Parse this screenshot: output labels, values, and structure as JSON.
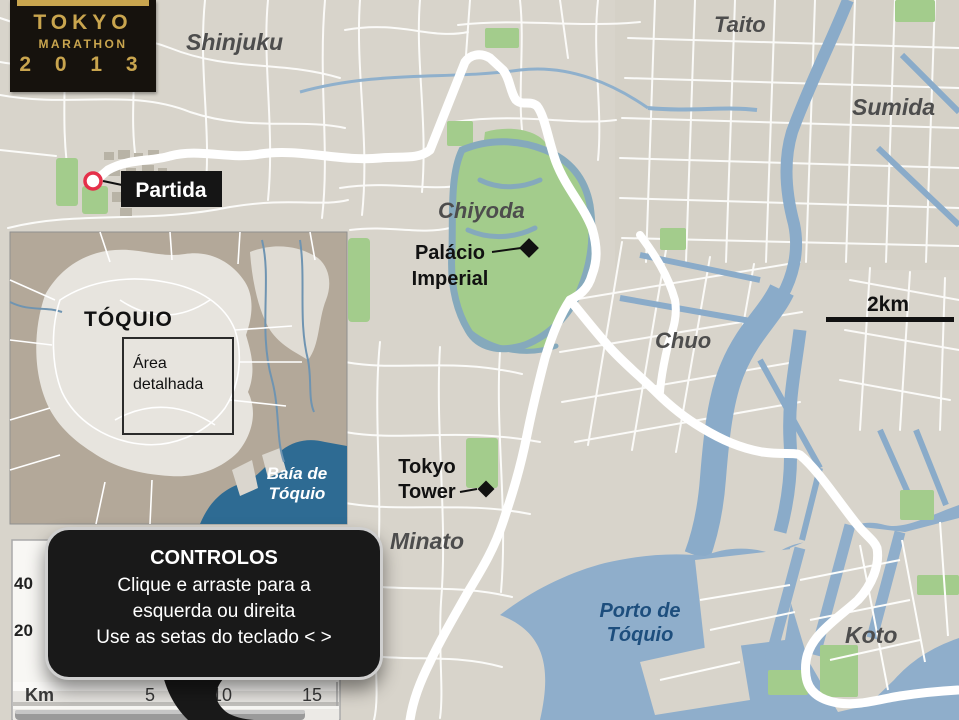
{
  "logo": {
    "title": "TOKYO",
    "subtitle": "MARATHON",
    "year": "2 0 1 3"
  },
  "map": {
    "districts": [
      {
        "label": "Shinjuku"
      },
      {
        "label": "Taito"
      },
      {
        "label": "Sumida"
      },
      {
        "label": "Chiyoda"
      },
      {
        "label": "Chuo"
      },
      {
        "label": "Minato"
      },
      {
        "label": "Koto"
      }
    ],
    "markers": {
      "start": {
        "label": "Partida"
      },
      "imperial_palace": {
        "line1": "Palácio",
        "line2": "Imperial"
      },
      "tokyo_tower": {
        "line1": "Tokyo",
        "line2": "Tower"
      }
    },
    "water_labels": {
      "port_line1": "Porto de",
      "port_line2": "Tóquio"
    },
    "scale_label": "2km"
  },
  "inset": {
    "title": "TÓQUIO",
    "area_line1": "Área",
    "area_line2": "detalhada",
    "bay_line1": "Baía de",
    "bay_line2": "Tóquio"
  },
  "elevation": {
    "y_ticks": [
      "40",
      "20"
    ],
    "x_unit": "Km",
    "x_ticks": [
      "5",
      "10",
      "15"
    ]
  },
  "tooltip": {
    "title": "CONTROLOS",
    "lines": [
      "Clique e arraste para a",
      "esquerda ou direita",
      "Use as setas do teclado < >"
    ]
  },
  "colors": {
    "land": "#D8D4CB",
    "water": "#8FAECB",
    "park": "#A3CC8C",
    "route": "#FFFFFF",
    "logo_gold": "#C9A54E",
    "start_marker_red": "#E5304A",
    "port_label_blue": "#1D4E7D",
    "inset_bay_blue": "#2E6B93"
  }
}
